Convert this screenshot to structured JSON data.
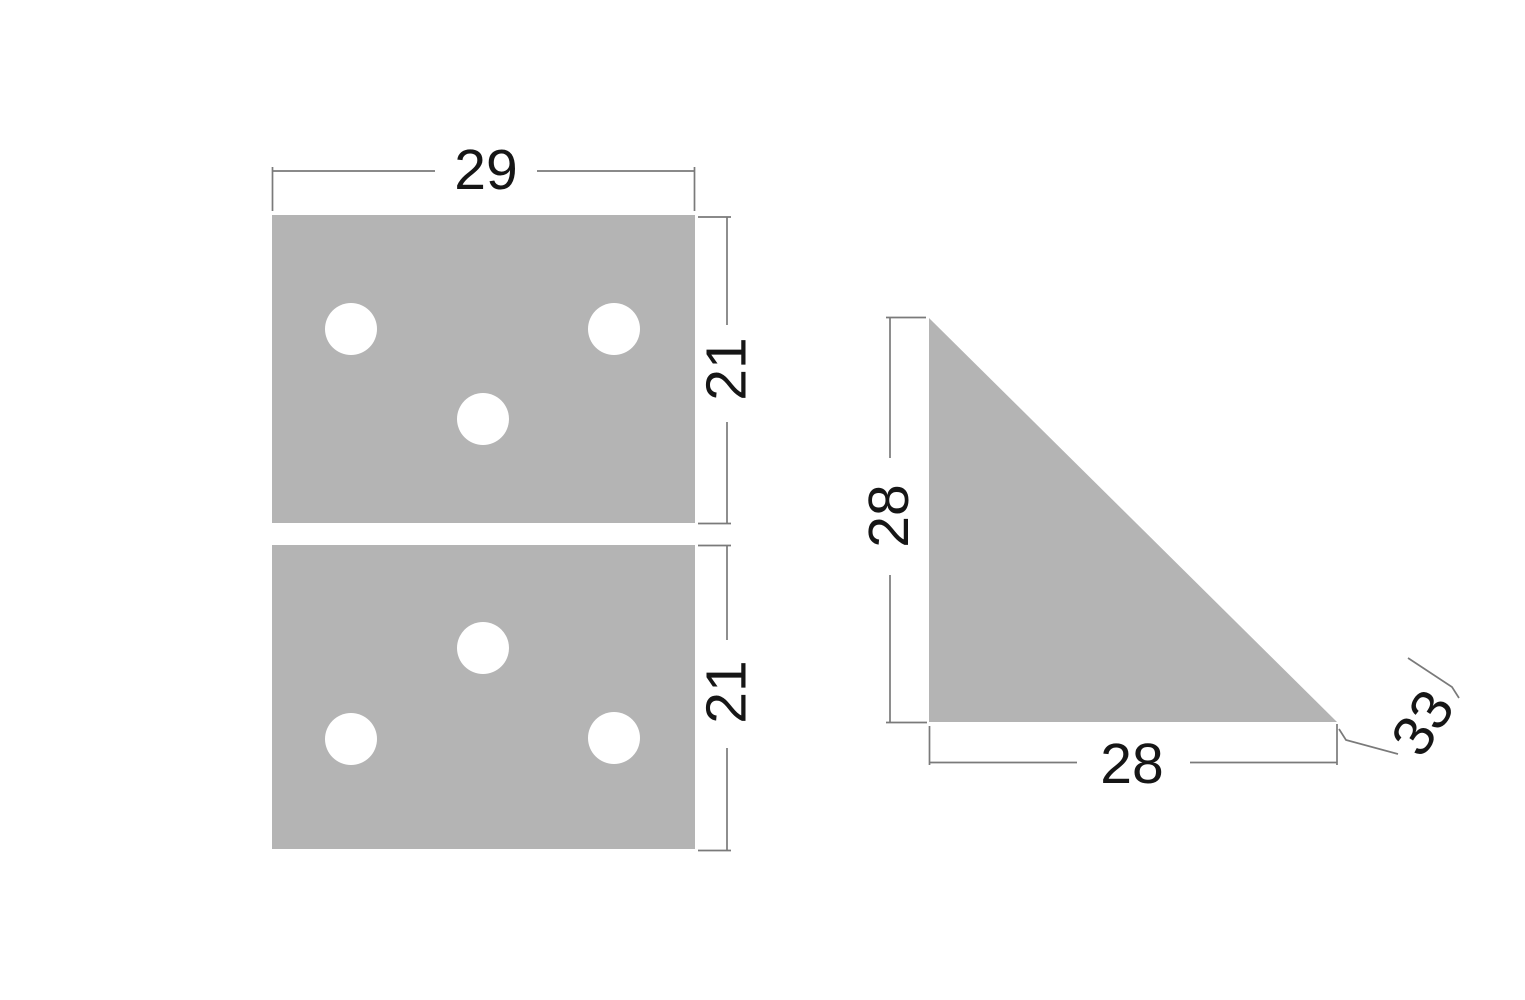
{
  "colors": {
    "background": "#ffffff",
    "part_fill": "#b4b4b4",
    "hole_fill": "#ffffff",
    "line": "#7a7a7a",
    "text": "#161616"
  },
  "dims": {
    "plate_width": "29",
    "plate_top_height": "21",
    "plate_bottom_height": "21",
    "triangle_height": "28",
    "triangle_base": "28",
    "triangle_hypotenuse": "33"
  },
  "parts": {
    "plate_top_hole_count": 3,
    "plate_bottom_hole_count": 3
  }
}
